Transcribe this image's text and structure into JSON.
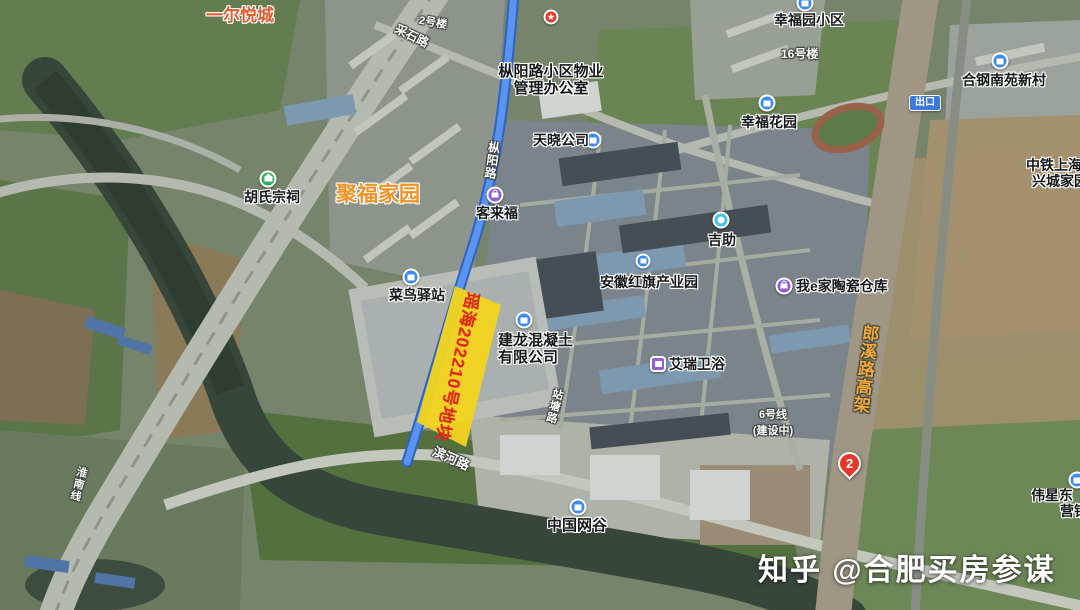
{
  "map": {
    "type": "satellite",
    "city_district": "合肥市瑶海区",
    "colors": {
      "parcel_fill": "#f2d41c",
      "parcel_text": "#e0271c",
      "route_blue": "#4a86e8",
      "poi_blue": "#3b8ced",
      "poi_purple": "#8f5fd6",
      "poi_green": "#2fae63",
      "poi_cyan": "#41c3ea",
      "pin_red": "#e8372a",
      "orange_label": "#ef9327",
      "watermark_white": "#ffffff"
    }
  },
  "parcel": {
    "label": "瑶海202210号地块"
  },
  "pois": {
    "yieryuecheng": "一尔悦城",
    "building2": "2号楼",
    "property_office": {
      "line1": "枞阳路小区物业",
      "line2": "管理办公室"
    },
    "tianxiao": "天晓公司",
    "xingfuyuan": "幸福园小区",
    "building16": "16号楼",
    "xingfuhuayuan": "幸福花园",
    "hegang": "合钢南苑新村",
    "zhongtie": {
      "line1": "中铁上海工",
      "line2": "兴城家园"
    },
    "hushizongci": "胡氏宗祠",
    "jufujiayuan": "聚福家园",
    "kelaifu": "客来福",
    "cainiao": "菜鸟驿站",
    "jizhu": "吉助",
    "hongqi": "安徽红旗产业园",
    "woejia": "我e家陶瓷仓库",
    "jianlong": {
      "line1": "建龙混凝土",
      "line2": "有限公司"
    },
    "airui": "艾瑞卫浴",
    "zhongguowanggu": "中国网谷",
    "metro6": {
      "line1": "6号线",
      "line2": "(建设中)"
    },
    "weixing": {
      "line1": "伟星东",
      "line2": "营销"
    },
    "exit_badge": "出口",
    "pin2": "2"
  },
  "roads": {
    "zongyanglu": "枞阳路",
    "binhelu": "滨河路",
    "langxilu_gaojia": "郎溪路高架",
    "caishilu": "采石路",
    "zhantanglu": "站塘路",
    "huainanxian": "淮南线"
  },
  "watermark": {
    "text": "知乎 @合肥买房参谋"
  }
}
